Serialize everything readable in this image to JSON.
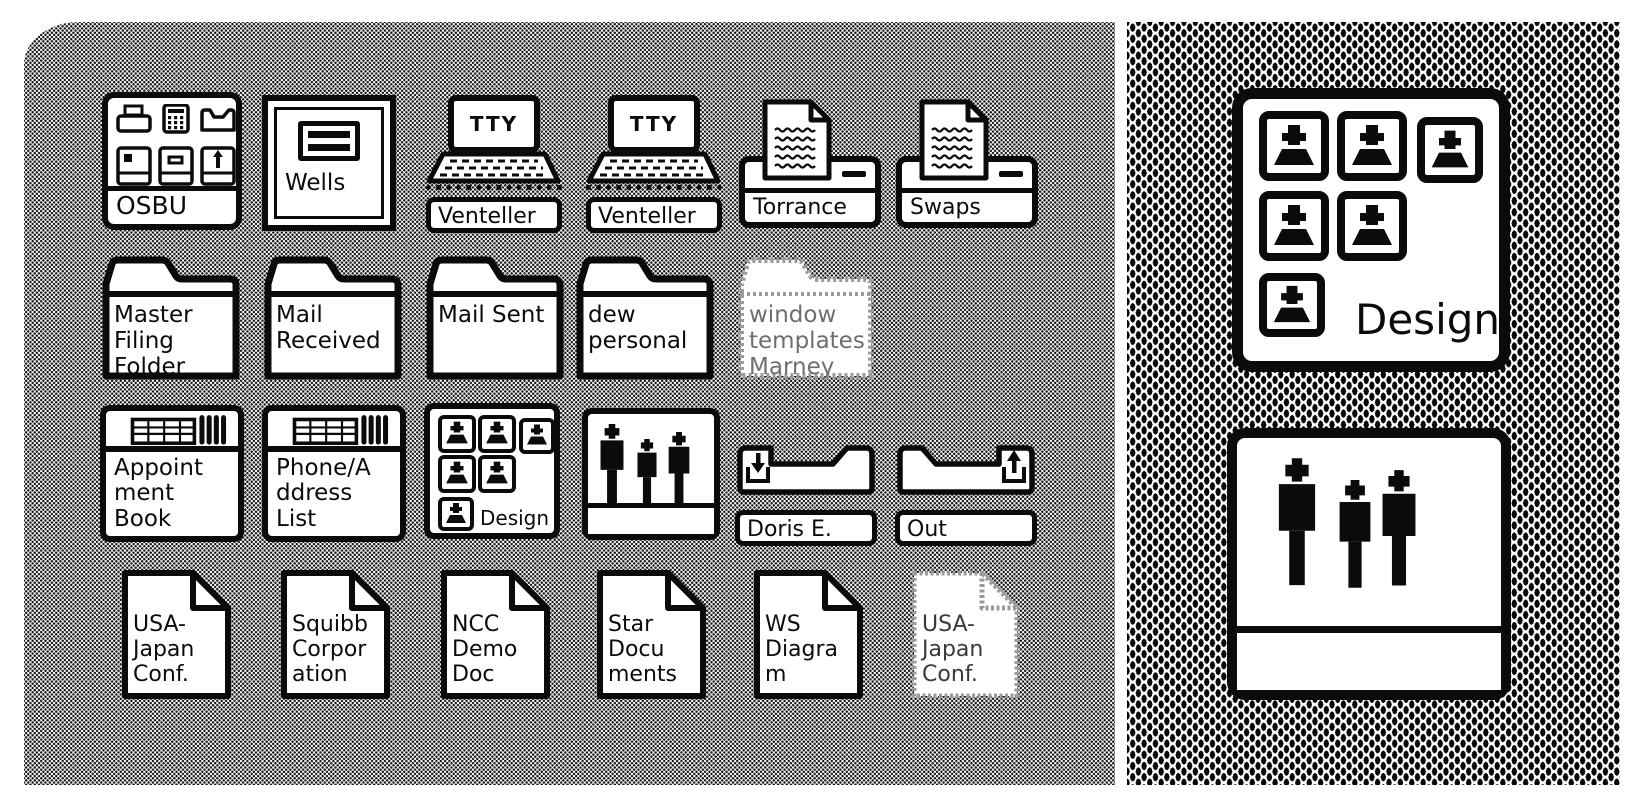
{
  "colors": {
    "ink": "#0b0b0b",
    "ghost_border": "#9b9b9b",
    "desktop_halftone": "#8c8c8c"
  },
  "icons": {
    "osbu": {
      "type": "directory",
      "label": "OSBU"
    },
    "wells": {
      "type": "mail-drawer",
      "label": "Wells"
    },
    "venteller1": {
      "type": "tty-terminal",
      "label": "Venteller",
      "screen": "TTY"
    },
    "venteller2": {
      "type": "tty-terminal",
      "label": "Venteller",
      "screen": "TTY"
    },
    "torrance": {
      "type": "printer",
      "label": "Torrance"
    },
    "swaps": {
      "type": "printer",
      "label": "Swaps"
    },
    "master_filing": {
      "type": "folder",
      "label": "Master Filing Folder"
    },
    "mail_received": {
      "type": "folder",
      "label": "Mail Received"
    },
    "mail_sent": {
      "type": "folder",
      "label": "Mail Sent"
    },
    "dew_personal": {
      "type": "folder",
      "label": "dew personal"
    },
    "window_templates": {
      "type": "folder-ghost",
      "label": "window templates Marney"
    },
    "appointment_book": {
      "type": "record-file",
      "label": "Appointment Book"
    },
    "phone_address": {
      "type": "record-file",
      "label": "Phone/Address List"
    },
    "design_group": {
      "type": "group-directory",
      "label": "Design"
    },
    "people_group": {
      "type": "people-directory",
      "label": ""
    },
    "in_tray_doris": {
      "type": "in-tray",
      "label": "Doris E."
    },
    "out_tray": {
      "type": "out-tray",
      "label": "Out"
    },
    "doc_usa_japan": {
      "type": "document",
      "label": "USA-Japan Conf."
    },
    "doc_squibb": {
      "type": "document",
      "label": "Squibb Corporation"
    },
    "doc_ncc": {
      "type": "document",
      "label": "NCC Demo Doc"
    },
    "doc_star": {
      "type": "document",
      "label": "Star Documents"
    },
    "doc_ws": {
      "type": "document",
      "label": "WS Diagram"
    },
    "doc_usa_japan_ghost": {
      "type": "document-ghost",
      "label": "USA-Japan Conf."
    }
  },
  "magnified": {
    "design_group": {
      "type": "group-directory",
      "label": "Design"
    },
    "people_group": {
      "type": "people-directory",
      "label": ""
    }
  }
}
